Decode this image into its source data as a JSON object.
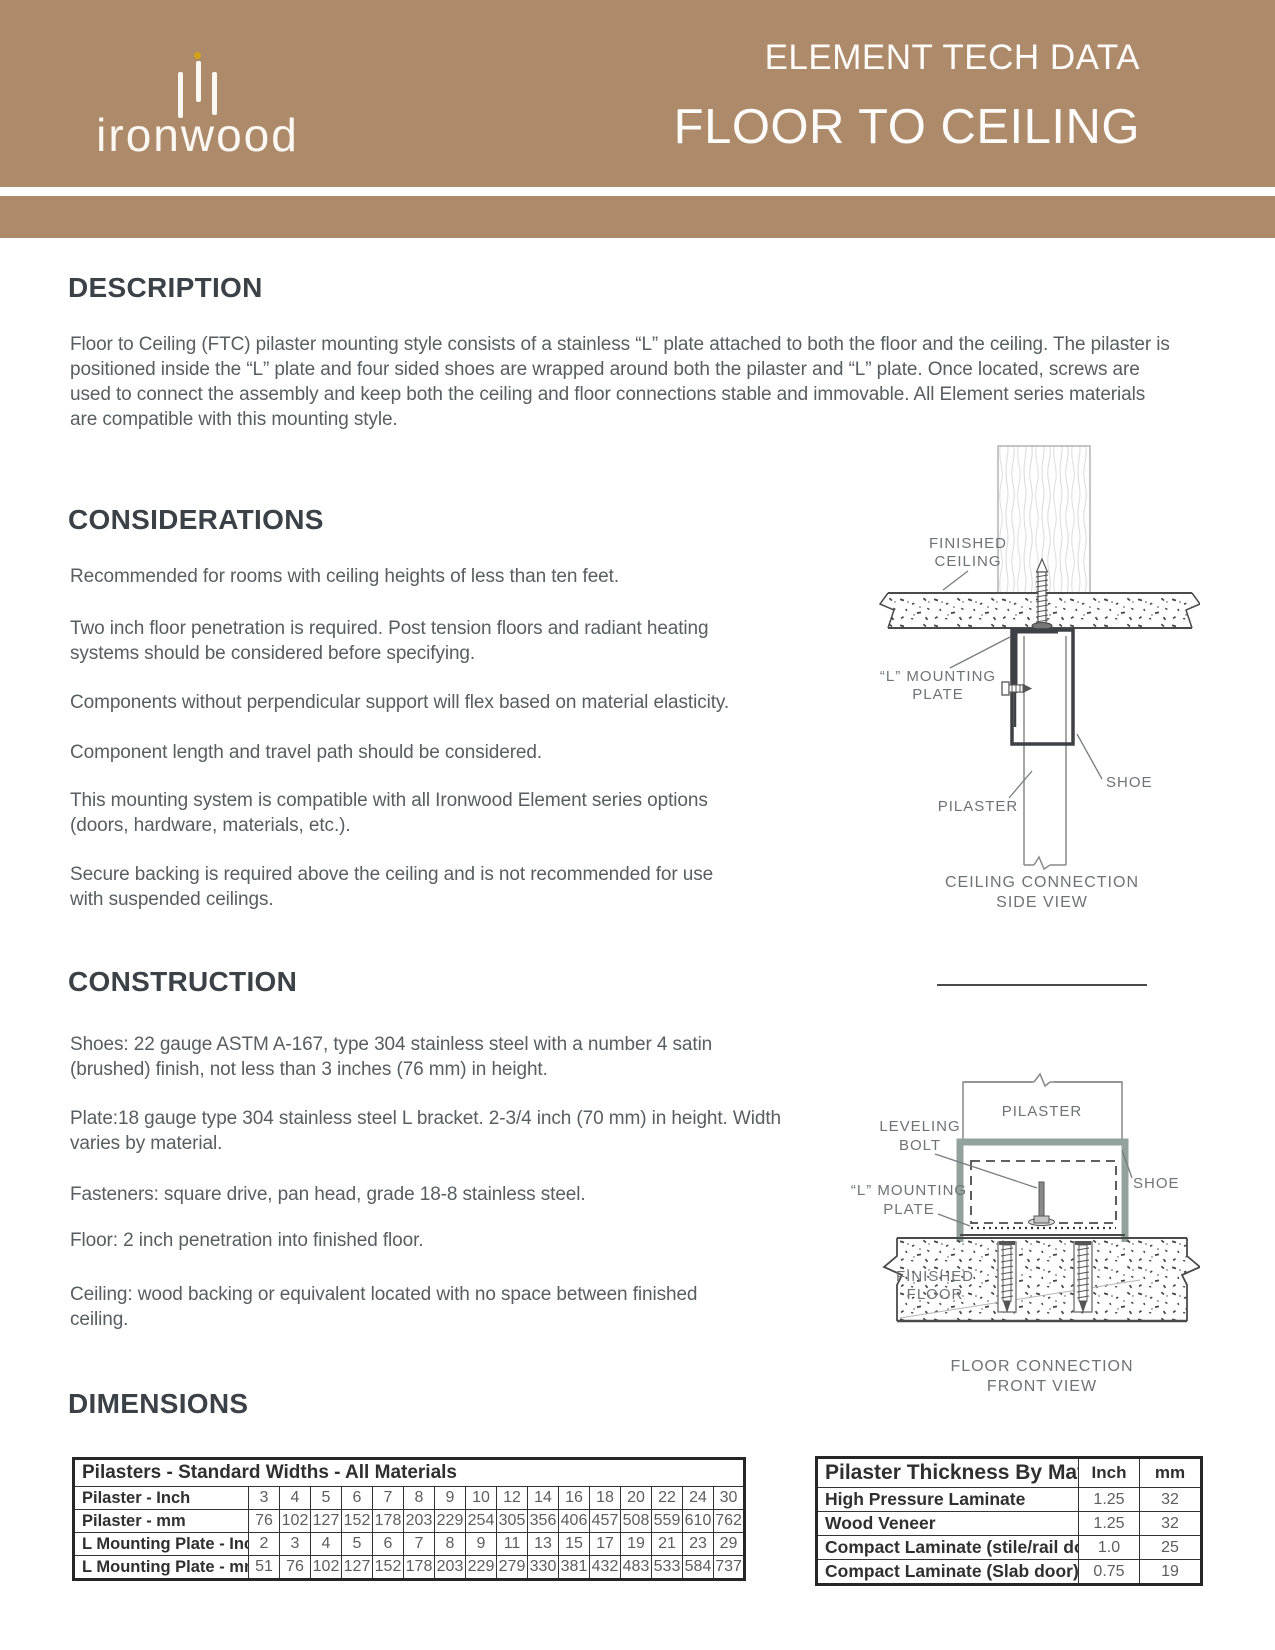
{
  "header": {
    "brand_name": "ironwood",
    "kicker": "ELEMENT TECH DATA",
    "title": "FLOOR TO CEILING"
  },
  "description": {
    "heading": "DESCRIPTION",
    "body": "Floor to Ceiling (FTC) pilaster mounting style consists of a stainless “L” plate attached to both the floor and the ceiling. The pilaster is positioned inside the “L” plate and four sided shoes are wrapped around both the pilaster and “L” plate. Once located, screws are used to connect the assembly and keep both the ceiling and floor connections stable and immovable. All Element series materials are compatible with this mounting style."
  },
  "considerations": {
    "heading": "CONSIDERATIONS",
    "p1": "Recommended for rooms with ceiling heights of less than ten feet.",
    "p2": "Two inch floor penetration is required. Post tension floors and radiant heating systems should be considered before specifying.",
    "p3": "Components without perpendicular support will flex based on material elasticity.",
    "p4": "Component length and travel path should be considered.",
    "p5": "This mounting system is compatible with all Ironwood Element series options (doors, hardware, materials, etc.).",
    "p6": "Secure backing is required above the ceiling and is not recommended for use with suspended ceilings."
  },
  "construction": {
    "heading": "CONSTRUCTION",
    "p1": "Shoes: 22 gauge ASTM A-167, type 304 stainless steel with a number 4 satin (brushed) finish, not less than 3 inches (76 mm) in height.",
    "p2": "Plate:18 gauge type 304 stainless steel L bracket. 2-3/4 inch (70 mm) in height. Width varies by material.",
    "p3": "Fasteners: square drive, pan head, grade 18-8 stainless steel.",
    "p4": "Floor: 2 inch penetration into finished floor.",
    "p5": "Ceiling: wood backing or equivalent located with no space between finished ceiling."
  },
  "dimensions": {
    "heading": "DIMENSIONS"
  },
  "ceiling_diagram": {
    "label_finished_ceiling_1": "FINISHED",
    "label_finished_ceiling_2": "CEILING",
    "label_mounting_plate_1": "“L” MOUNTING",
    "label_mounting_plate_2": "PLATE",
    "label_shoe": "SHOE",
    "label_pilaster": "PILASTER",
    "caption_1": "CEILING CONNECTION",
    "caption_2": "SIDE VIEW"
  },
  "floor_diagram": {
    "label_pilaster": "PILASTER",
    "label_leveling_bolt_1": "LEVELING",
    "label_leveling_bolt_2": "BOLT",
    "label_mounting_plate_1": "“L” MOUNTING",
    "label_mounting_plate_2": "PLATE",
    "label_shoe": "SHOE",
    "label_finished_floor_1": "FINISHED",
    "label_finished_floor_2": "FLOOR",
    "caption_1": "FLOOR CONNECTION",
    "caption_2": "FRONT VIEW"
  },
  "widths_table": {
    "title": "Pilasters - Standard Widths - All Materials",
    "rows": [
      {
        "label": "Pilaster - Inch",
        "values": [
          "3",
          "4",
          "5",
          "6",
          "7",
          "8",
          "9",
          "10",
          "12",
          "14",
          "16",
          "18",
          "20",
          "22",
          "24",
          "30"
        ]
      },
      {
        "label": "Pilaster - mm",
        "values": [
          "76",
          "102",
          "127",
          "152",
          "178",
          "203",
          "229",
          "254",
          "305",
          "356",
          "406",
          "457",
          "508",
          "559",
          "610",
          "762"
        ]
      },
      {
        "label": "L Mounting Plate - Inch",
        "values": [
          "2",
          "3",
          "4",
          "5",
          "6",
          "7",
          "8",
          "9",
          "11",
          "13",
          "15",
          "17",
          "19",
          "21",
          "23",
          "29"
        ]
      },
      {
        "label": "L Mounting Plate - mm",
        "values": [
          "51",
          "76",
          "102",
          "127",
          "152",
          "178",
          "203",
          "229",
          "279",
          "330",
          "381",
          "432",
          "483",
          "533",
          "584",
          "737"
        ]
      }
    ]
  },
  "thickness_table": {
    "title": "Pilaster Thickness By Material",
    "col_inch": "Inch",
    "col_mm": "mm",
    "rows": [
      {
        "label": "High Pressure Laminate",
        "inch": "1.25",
        "mm": "32"
      },
      {
        "label": "Wood Veneer",
        "inch": "1.25",
        "mm": "32"
      },
      {
        "label": "Compact Laminate (stile/rail door)",
        "inch": "1.0",
        "mm": "25"
      },
      {
        "label": "Compact Laminate (Slab door)",
        "inch": "0.75",
        "mm": "19"
      }
    ]
  },
  "colors": {
    "header_brown": "#ad8a69",
    "logo_gold": "#d2a117",
    "heading_dark": "#3a4147",
    "body_gray": "#575e61",
    "shoe_green": "#93a29b"
  }
}
